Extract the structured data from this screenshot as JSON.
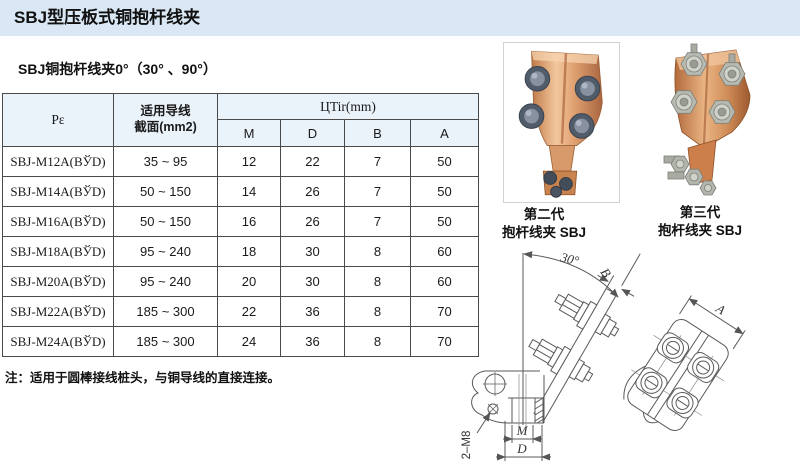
{
  "page": {
    "title": "SBJ型压板式铜抱杆线夹",
    "subtitle": "SBJ铜抱杆线夹0°（30° 、90°）",
    "note": "注：适用于圆棒接线桩头，与铜导线的直接连接。"
  },
  "table": {
    "header": {
      "model": "Pε",
      "wire_line1": "适用导线",
      "wire_line2": "截面(mm2)",
      "dims_group": "ЦTir(mm)",
      "m": "M",
      "d": "D",
      "b": "B",
      "a": "A"
    },
    "rows": [
      {
        "model": "SBJ-M12A(BЎD)",
        "section": "35 ~ 95",
        "m": "12",
        "d": "22",
        "b": "7",
        "a": "50"
      },
      {
        "model": "SBJ-M14A(BЎD)",
        "section": "50 ~ 150",
        "m": "14",
        "d": "26",
        "b": "7",
        "a": "50"
      },
      {
        "model": "SBJ-M16A(BЎD)",
        "section": "50 ~ 150",
        "m": "16",
        "d": "26",
        "b": "7",
        "a": "50"
      },
      {
        "model": "SBJ-M18A(BЎD)",
        "section": "95 ~ 240",
        "m": "18",
        "d": "30",
        "b": "8",
        "a": "60"
      },
      {
        "model": "SBJ-M20A(BЎD)",
        "section": "95 ~ 240",
        "m": "20",
        "d": "30",
        "b": "8",
        "a": "60"
      },
      {
        "model": "SBJ-M22A(BЎD)",
        "section": "185 ~ 300",
        "m": "22",
        "d": "36",
        "b": "8",
        "a": "70"
      },
      {
        "model": "SBJ-M24A(BЎD)",
        "section": "185 ~ 300",
        "m": "24",
        "d": "36",
        "b": "8",
        "a": "70"
      }
    ]
  },
  "products": {
    "gen2": {
      "line1": "第二代",
      "line2": "抱杆线夹 SBJ"
    },
    "gen3": {
      "line1": "第三代",
      "line2": "抱杆线夹 SBJ"
    }
  },
  "drawing": {
    "angle": "30°",
    "b": "B",
    "m": "M",
    "d": "D",
    "a": "A",
    "thread": "2–M8"
  },
  "colors": {
    "header_band": "#d9e8f4",
    "table_header_bg": "#eaf2fa",
    "table_border": "#4a4a4a",
    "copper": "#d99a6c",
    "bolt_steel_dark": "#515c6a",
    "bolt_steel_light": "#b7bab1",
    "drawing_line": "#5a5a5a"
  }
}
